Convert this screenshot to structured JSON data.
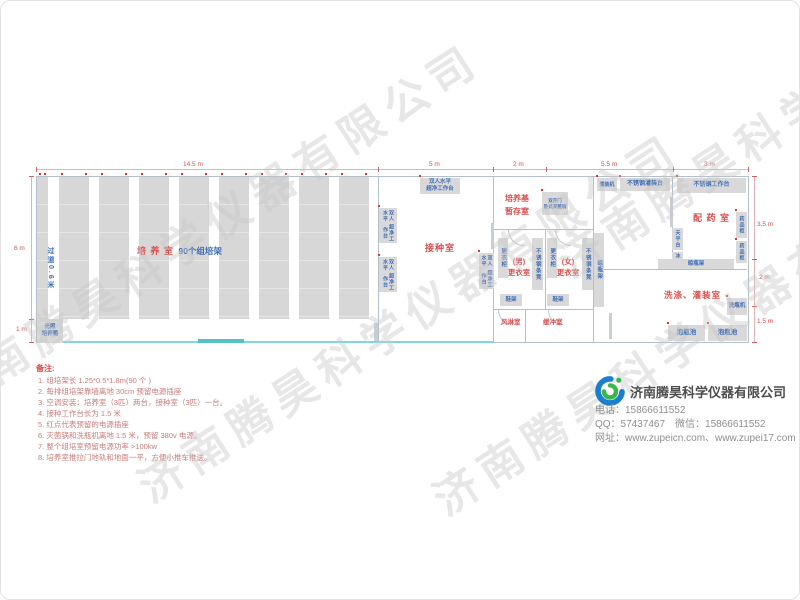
{
  "watermark": "济南腾昊科学仪器有限公司",
  "dims": {
    "top": [
      "14.5 m",
      "5 m",
      "2 m",
      "5.5 m",
      "3 m"
    ],
    "left": [
      "6 m",
      "1 m"
    ],
    "right": [
      "3.5 m",
      "2 m",
      "1.5 m"
    ]
  },
  "rooms": {
    "culture": "培 养 室",
    "culture_sub": "90个组培架",
    "aisle": "过道0.6米",
    "inoculation": "接种室",
    "medium_storage": "培养基暂存室",
    "male": "(男)",
    "female": "(女)",
    "changing": "更衣室",
    "air_shower": "风淋室",
    "buffer": "缓冲室",
    "dispensing": "配 药 室",
    "washing": "洗涤、灌装室"
  },
  "equipment": {
    "incubator_l1": "光照",
    "incubator_l2": "培养箱",
    "workbench_l1": "双人水平",
    "workbench_l2": "超净工作台",
    "sterilizer_l1": "双开门",
    "sterilizer_l2": "卧式灭菌锅",
    "locker": "更衣柜",
    "bench": "不锈钢条凳",
    "shoe_rack": "鞋架",
    "bottle_rack": "晾瓶架",
    "filling_machine": "灌装机",
    "filling_table": "不锈钢灌装台",
    "work_table": "不锈钢工作台",
    "balance": "天平台",
    "fridge": "冰箱",
    "medicine_cabinet": "药品柜",
    "bottle_washer": "洗瓶机",
    "soak_pool": "泡瓶池"
  },
  "notes": {
    "title": "备注:",
    "items": [
      "1.  组培架长 1.25*0.5*1.8m(90 个 )",
      "2.  每排组培架靠墙离地 30cm 预留电源插座",
      "3.  空调安装：培养室（3匹）两台，接种室（3匹）一台。",
      "4.  接种工作台长为 1.5 米",
      "5.  红点代表预留的电源插座",
      "6.  灭菌锅和洗瓶机离地 1.5 米，预留 380v 电源。",
      "7.  整个组培室预留电源功率 >100kw",
      "8.  培养室推拉门地轨和地面一平，方便小推车推送。"
    ]
  },
  "company": {
    "name": "济南腾昊科学仪器有限公司",
    "phone_line": "电话：15866611552",
    "qq_line": "QQ：57437467　微信：15866611552",
    "web_line": "网址：www.zupeicn.com、www.zupei17.com"
  },
  "colors": {
    "room_label_red": "#d84f4f",
    "equipment_blue": "#3f6db5",
    "equipment_gray": "#d9d9d9",
    "wall_gray": "#b3bfca",
    "door_cyan": "#7fd8dc",
    "outlet_red": "#e03434",
    "logo_blue": "#1b7fd0",
    "logo_green": "#3cb54a"
  }
}
